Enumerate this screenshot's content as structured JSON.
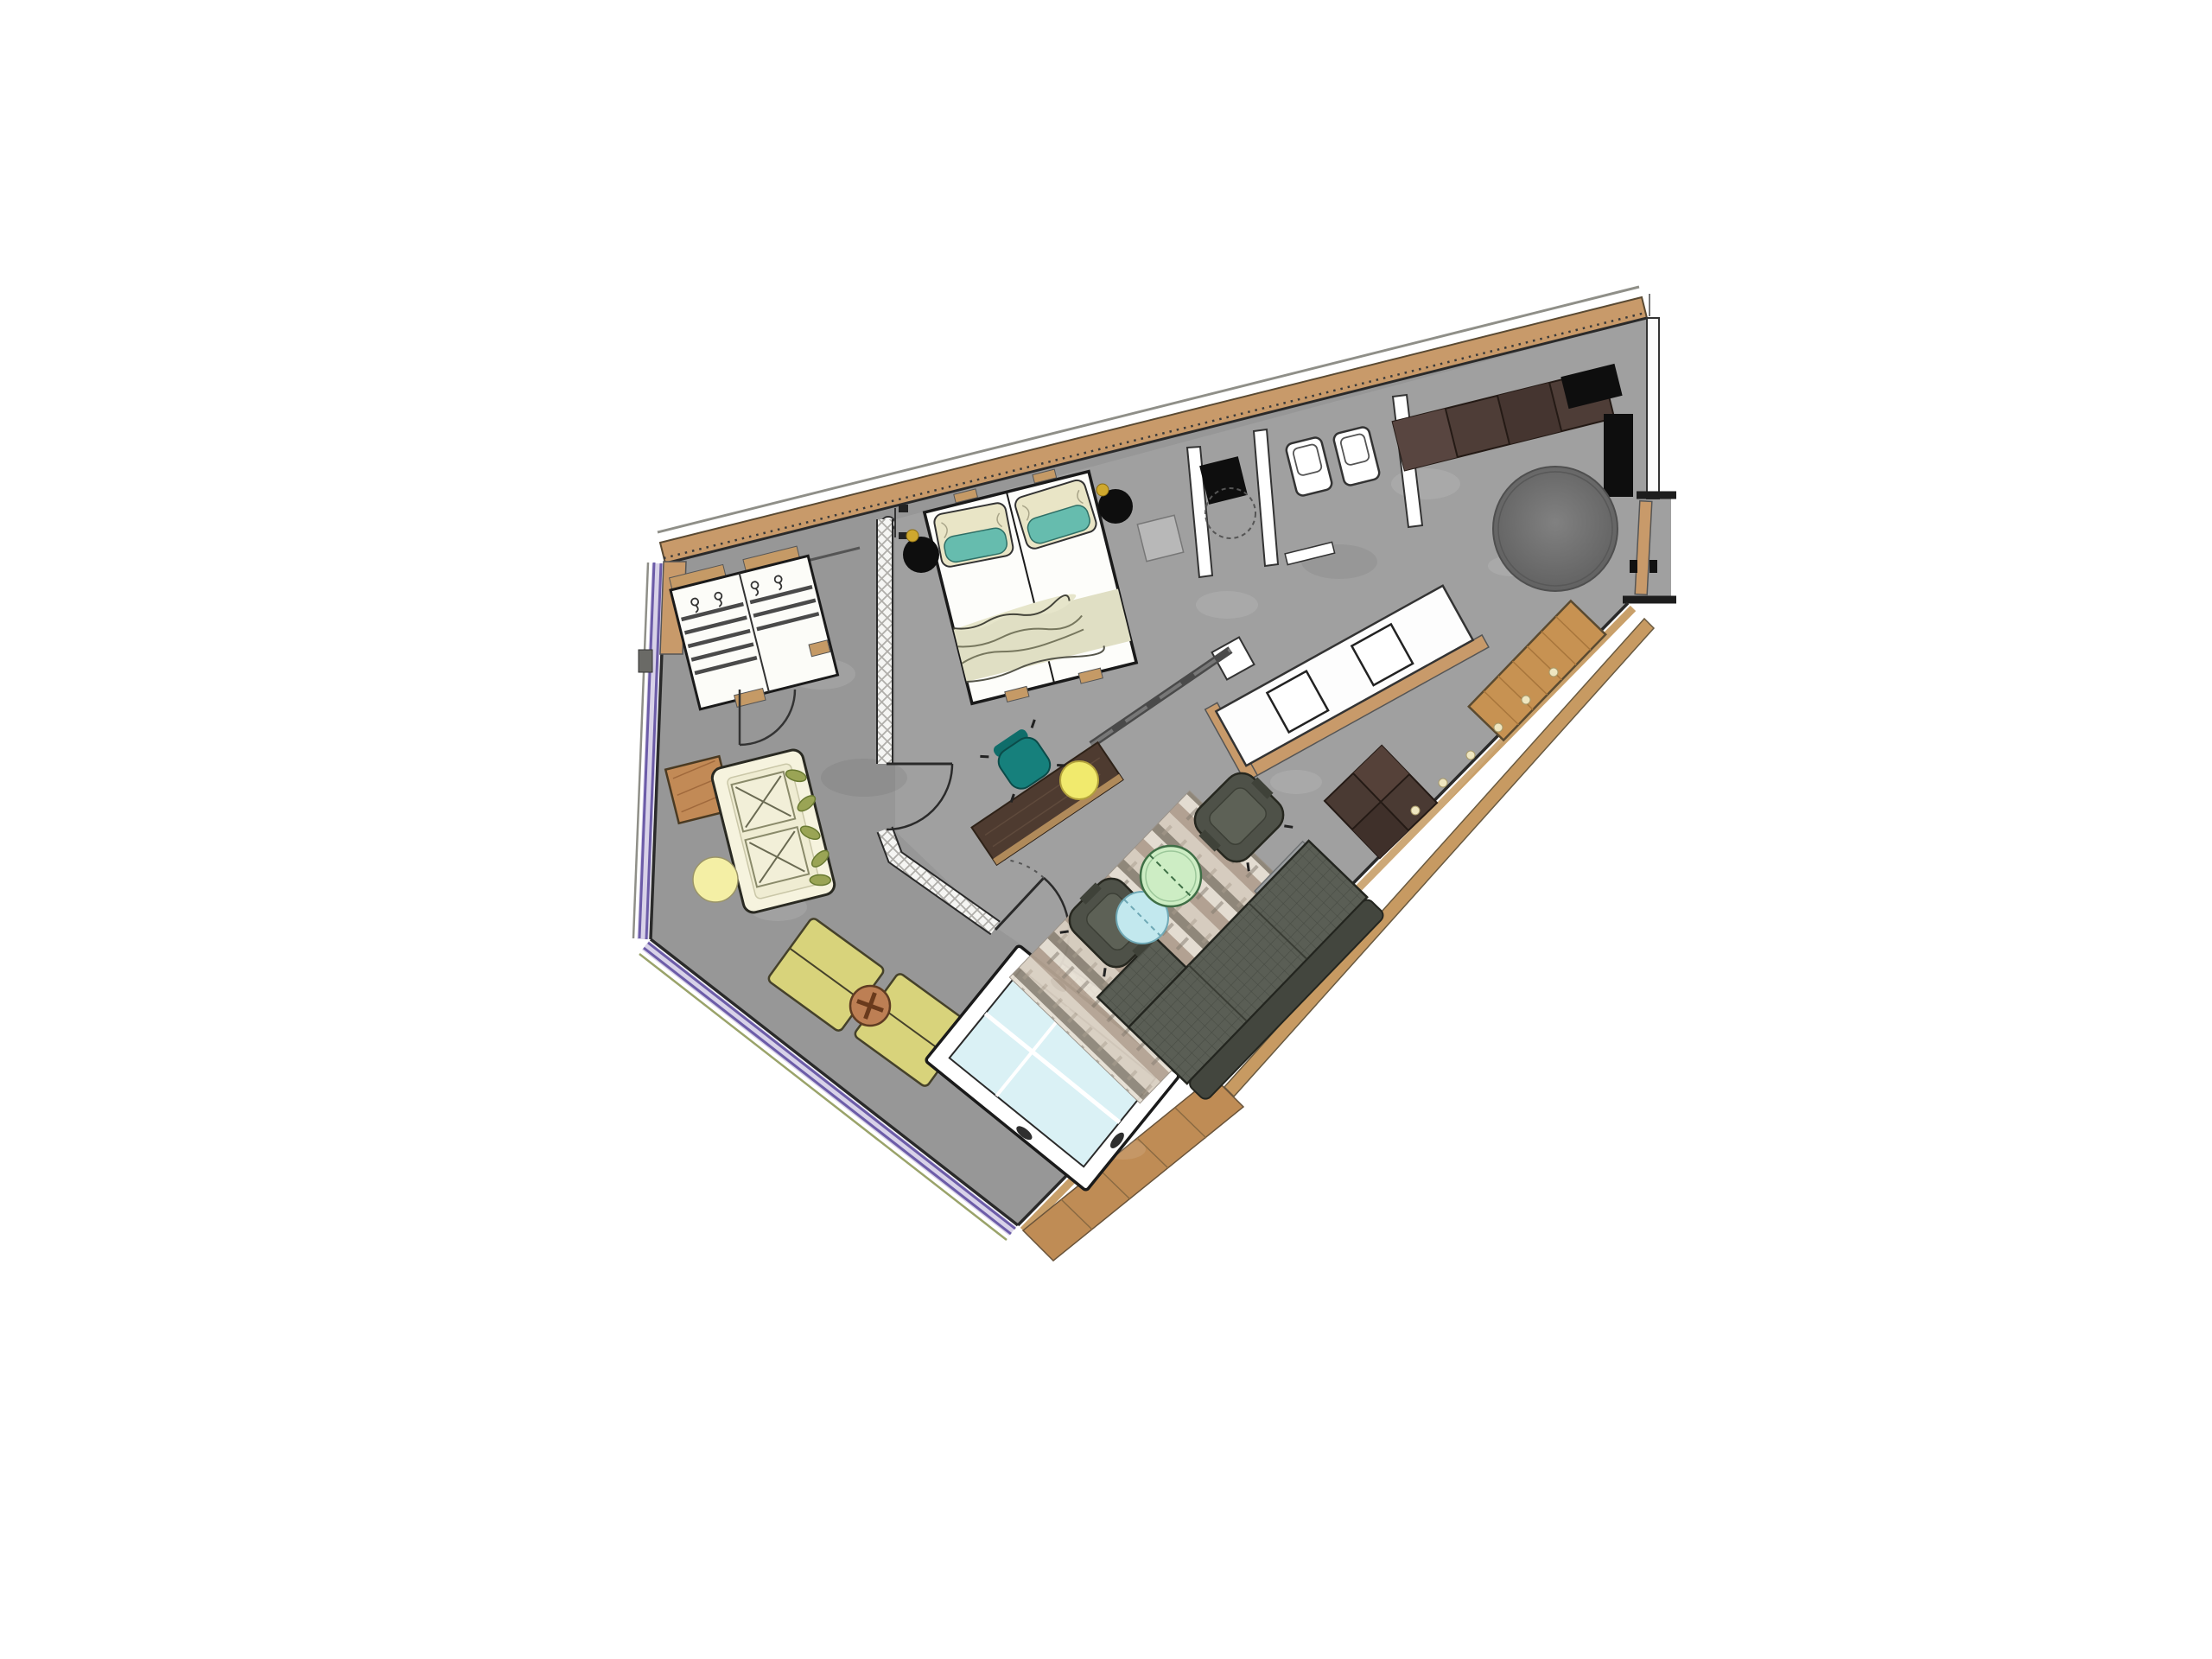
{
  "meta": {
    "type": "floor-plan",
    "description": "Angled apartment suite floor plan on white background"
  },
  "palette": {
    "floor": "#979797",
    "wall_line": "#2a2a2a",
    "wall_white": "#fbfbfb",
    "wood": "#c89a6a",
    "wood_sill": "#c9a06a",
    "wood_deck": "#bf8c55",
    "glazing": "#6c5ca8",
    "glazing_band": "#d8d2e8",
    "glazing_outer": "#9aa36a",
    "black": "#0e0e0e",
    "sofa_back": "#43463e",
    "armchair": "#4e5148",
    "armchair_seat": "#5d6156",
    "side_table_gray": "#9b9ea0",
    "lounge_sofa": "#f6f3de",
    "lounge_seat": "#efecd2",
    "leaf": "#9aa455",
    "side_table": "#c28a56",
    "pouf": "#f4efa5",
    "cushion": "#d8d37b",
    "cross_table": "#bd7f54",
    "daybed": "#daf1f5",
    "bed_frame": "#fdfdfa",
    "pillow_teal": "#66bcae",
    "pillow_cream": "#e9e5c6",
    "blanket": "#e0dfc4",
    "desk": "#4e3b30",
    "desk_chair": "#16807c",
    "stool": "#f1ea6d",
    "table_green": "#cdedc4",
    "table_blue": "#c2e8ee",
    "sideboard": "#4e3d37",
    "ottoman": "#4a3a33",
    "bench_wood": "#c79252",
    "shelf_gray": "#b8b8b8",
    "gold": "#cfa82e",
    "candle": "#efe6c0"
  },
  "legend": [
    {
      "id": "entry-door",
      "label": "Entry door"
    },
    {
      "id": "entry-vestibule",
      "label": "Entry vestibule"
    },
    {
      "id": "entry-closet",
      "label": "Entry closet panel"
    },
    {
      "id": "sideboard",
      "label": "Sideboard"
    },
    {
      "id": "tv-panel",
      "label": "TV panel"
    },
    {
      "id": "round-rug",
      "label": "Round rug"
    },
    {
      "id": "wall-bench",
      "label": "Window bench"
    },
    {
      "id": "ottoman",
      "label": "Ottoman table"
    },
    {
      "id": "sofa",
      "label": "Sofa"
    },
    {
      "id": "armchair",
      "label": "Armchair"
    },
    {
      "id": "coffee-table-green",
      "label": "Glass coffee table"
    },
    {
      "id": "coffee-table-blue",
      "label": "Glass side table"
    },
    {
      "id": "area-rug",
      "label": "Striped area rug"
    },
    {
      "id": "vanity",
      "label": "Vanity with twin basins"
    },
    {
      "id": "shower",
      "label": "Shower"
    },
    {
      "id": "wc",
      "label": "WC fixtures"
    },
    {
      "id": "glass-partition",
      "label": "Glazed partition wall"
    },
    {
      "id": "desk",
      "label": "Desk"
    },
    {
      "id": "desk-chair",
      "label": "Desk chair"
    },
    {
      "id": "double-bed",
      "label": "Double bed"
    },
    {
      "id": "bedside-pendant",
      "label": "Bedside pendant table"
    },
    {
      "id": "wardrobe",
      "label": "Wardrobe"
    },
    {
      "id": "lounge-sofa",
      "label": "Lounge sofa"
    },
    {
      "id": "floor-cushion",
      "label": "Floor cushion"
    },
    {
      "id": "daybed",
      "label": "Daybed"
    },
    {
      "id": "balcony-deck",
      "label": "Balcony deck"
    }
  ]
}
